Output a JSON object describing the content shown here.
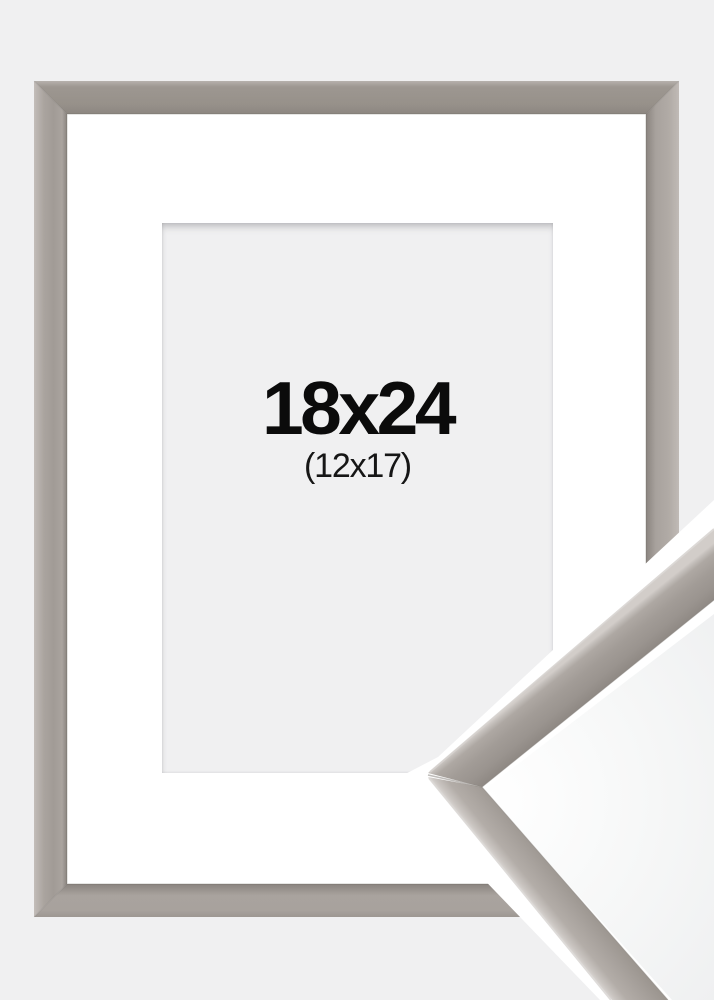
{
  "product": {
    "size_label": "18x24",
    "matted_size_label": "(12x17)"
  },
  "colors": {
    "background": "#f0f0f1",
    "frame_base": "#a29c97",
    "frame_highlight": "#c6c1bd",
    "frame_shadow": "#8a847f",
    "mat": "#ffffff",
    "opening_background": "#f0f0f1",
    "text_primary": "#0b0b0b",
    "text_secondary": "#161616",
    "sample_background": "#ffffff"
  }
}
